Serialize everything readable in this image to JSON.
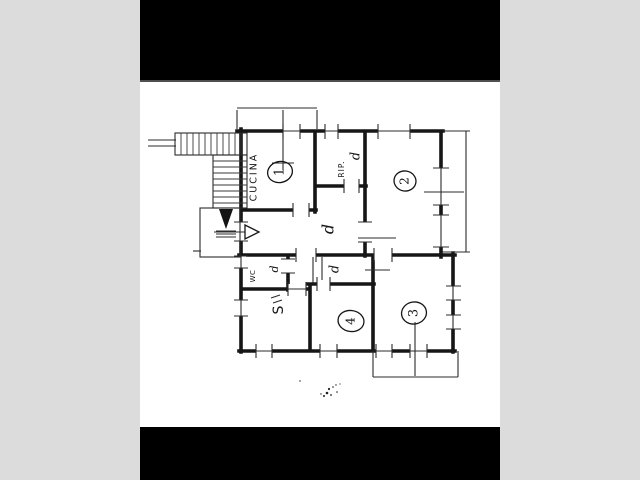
{
  "page": {
    "background_color": "#dcdcdc",
    "scan_background": "#ffffff",
    "bar_color": "#000000",
    "ink_color": "#161616"
  },
  "floor_plan": {
    "room_labels": {
      "kitchen": "CUCINA",
      "storage": "RIP.",
      "wc": "WC",
      "living": "S"
    },
    "room_numbers": {
      "room1": "1",
      "room2": "2",
      "room3": "3",
      "room4": "4"
    },
    "door_marks": {
      "storage_door": "d",
      "hall_door": "d",
      "room4_door": "d",
      "wc_door": "d"
    }
  }
}
